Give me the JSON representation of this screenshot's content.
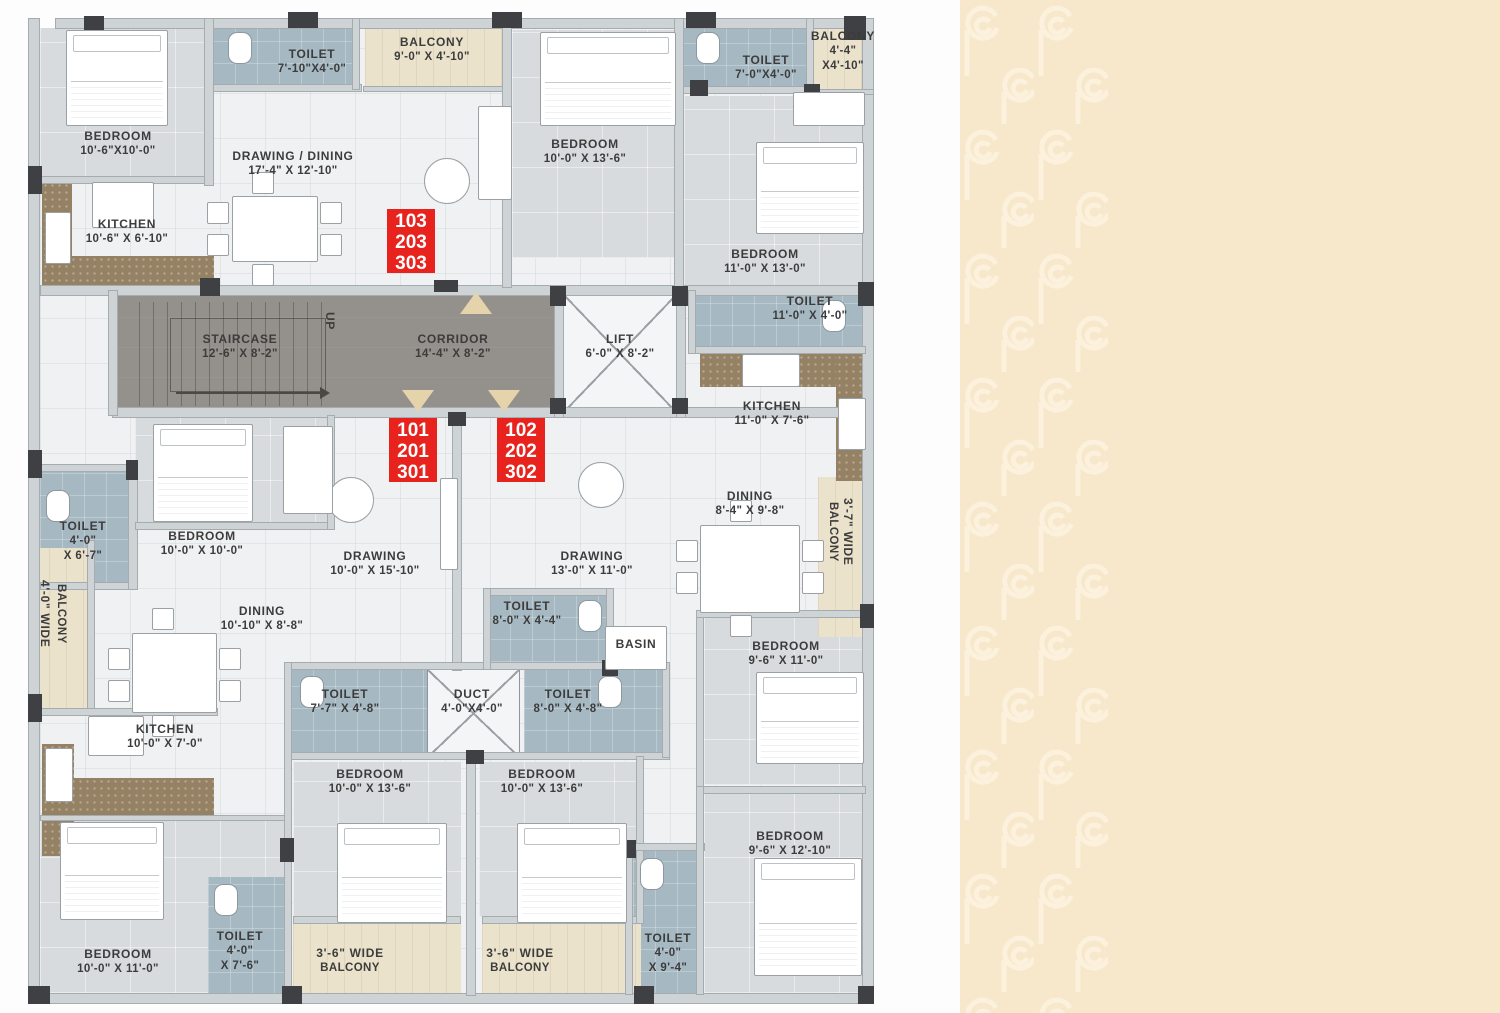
{
  "plan": {
    "labels": [
      {
        "lines": [
          "BEDROOM",
          "10'-6\"X10'-0\""
        ]
      },
      {
        "lines": [
          "TOILET",
          "7'-10\"X4'-0\""
        ]
      },
      {
        "lines": [
          "BALCONY",
          "9'-0\" X 4'-10\""
        ]
      },
      {
        "lines": [
          "DRAWING / DINING",
          "17'-4\" X 12'-10\""
        ]
      },
      {
        "lines": [
          "KITCHEN",
          "10'-6\" X 6'-10\""
        ]
      },
      {
        "lines": [
          "BEDROOM",
          "10'-0\" X 13'-6\""
        ]
      },
      {
        "lines": [
          "TOILET",
          "7'-0\"X4'-0\""
        ]
      },
      {
        "lines": [
          "BALCONY",
          "4'-4\"",
          "X4'-10\""
        ]
      },
      {
        "lines": [
          "BEDROOM",
          "11'-0\" X 13'-0\""
        ]
      },
      {
        "lines": [
          "STAIRCASE",
          "12'-6\" X 8'-2\""
        ]
      },
      {
        "lines": [
          "CORRIDOR",
          "14'-4\" X 8'-2\""
        ]
      },
      {
        "lines": [
          "LIFT",
          "6'-0\" X 8'-2\""
        ]
      },
      {
        "lines": [
          "TOILET",
          "11'-0\" X 4'-0\""
        ]
      },
      {
        "lines": [
          "KITCHEN",
          "11'-0\" X 7'-6\""
        ]
      },
      {
        "lines": [
          "DINING",
          "8'-4\" X 9'-8\""
        ]
      },
      {
        "lines": [
          "3'-7\" WIDE",
          "BALCONY"
        ]
      },
      {
        "lines": [
          "TOILET",
          "4'-0\"",
          "X 6'-7\""
        ]
      },
      {
        "lines": [
          "BEDROOM",
          "10'-0\" X 10'-0\""
        ]
      },
      {
        "lines": [
          "DRAWING",
          "10'-0\" X 15'-10\""
        ]
      },
      {
        "lines": [
          "DRAWING",
          "13'-0\" X 11'-0\""
        ]
      },
      {
        "lines": [
          "DINING",
          "10'-10\" X 8'-8\""
        ]
      },
      {
        "lines": [
          "4'-0\" WIDE",
          "BALCONY"
        ]
      },
      {
        "lines": [
          "KITCHEN",
          "10'-0\" X 7'-0\""
        ]
      },
      {
        "lines": [
          "BEDROOM",
          "10'-0\" X 11'-0\""
        ]
      },
      {
        "lines": [
          "TOILET",
          "4'-0\"",
          "X 7'-6\""
        ]
      },
      {
        "lines": [
          "TOILET",
          "7'-7\" X 4'-8\""
        ]
      },
      {
        "lines": [
          "DUCT",
          "4'-0\"X4'-0\""
        ]
      },
      {
        "lines": [
          "TOILET",
          "8'-0\" X 4'-8\""
        ]
      },
      {
        "lines": [
          "BEDROOM",
          "10'-0\" X 13'-6\""
        ]
      },
      {
        "lines": [
          "BEDROOM",
          "10'-0\" X 13'-6\""
        ]
      },
      {
        "lines": [
          "BASIN"
        ]
      },
      {
        "lines": [
          "TOILET",
          "8'-0\" X 4'-4\""
        ]
      },
      {
        "lines": [
          "BEDROOM",
          "9'-6\" X 11'-0\""
        ]
      },
      {
        "lines": [
          "3'-6\" WIDE",
          "BALCONY"
        ]
      },
      {
        "lines": [
          "3'-6\" WIDE",
          "BALCONY"
        ]
      },
      {
        "lines": [
          "TOILET",
          "4'-0\"",
          "X 9'-4\""
        ]
      },
      {
        "lines": [
          "BEDROOM",
          "9'-6\" X 12'-10\""
        ]
      },
      {
        "lines": [
          "UP"
        ]
      }
    ],
    "markers": [
      {
        "lines": [
          "103",
          "203",
          "303"
        ]
      },
      {
        "lines": [
          "101",
          "201",
          "301"
        ]
      },
      {
        "lines": [
          "102",
          "202",
          "302"
        ]
      }
    ]
  },
  "sidebar": {
    "title": {
      "parts": [
        {
          "n": "1",
          "s": "st"
        },
        {
          "n": "2",
          "s": "nd"
        },
        {
          "n": "3",
          "s": "rd"
        }
      ],
      "separator": ", ",
      "subtitle": "Floor Plan"
    },
    "compass": {
      "e": "E",
      "n": "N",
      "s": "S",
      "w": "W"
    },
    "table": {
      "col1": "Flat no.",
      "col2": "Type",
      "col3a": "Saleable",
      "col3b": "area",
      "rows": [
        {
          "flat": "101, 201 & 301",
          "type": "3BHK",
          "area": "1425"
        },
        {
          "flat": "102, 202 & 302",
          "type": "3BHK",
          "area": "1465"
        },
        {
          "flat": "103, 203 & 303",
          "type": "3BHK",
          "area": "1425"
        }
      ],
      "footnote": "in SQFT."
    },
    "colors": {
      "beige": "#f7e7cb",
      "pattern_cream": "#fbf1dd",
      "title_maroon": "#7b3a28",
      "header_brown": "#6f392b",
      "row_alt": "#fcf3df",
      "marker_red": "#e8231d",
      "compass_gray": "#6b7076",
      "compass_needle_brown": "#8a3a26"
    }
  }
}
